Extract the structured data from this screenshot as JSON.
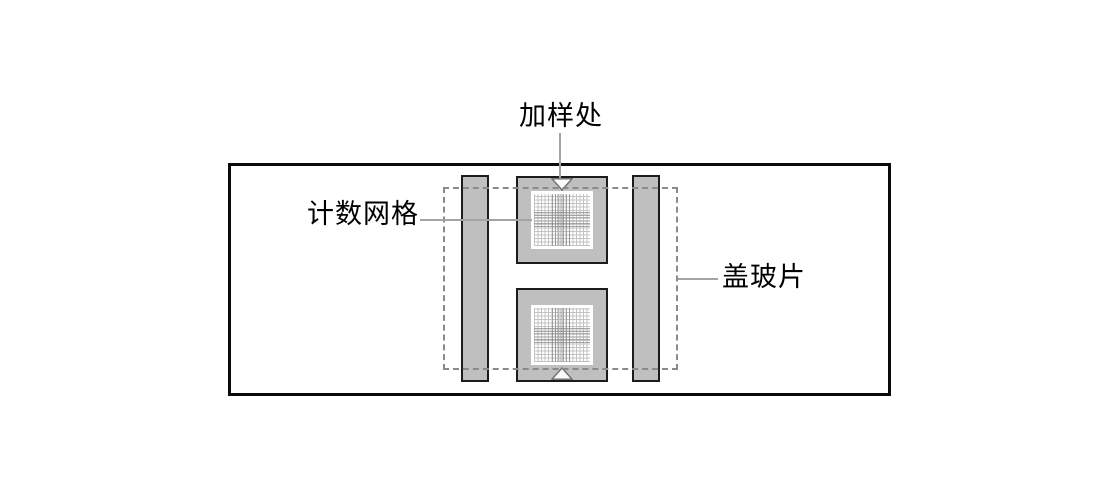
{
  "labels": {
    "sample_port": "加样处",
    "counting_grid": "计数网格",
    "cover_glass": "盖玻片"
  },
  "colors": {
    "background": "#ffffff",
    "slide_border": "#0a0a0a",
    "shape_fill": "#bfbfbf",
    "shape_border": "#1c1c1c",
    "dashed_outline": "#8a8a8a",
    "leader_line": "#a3a3a3",
    "grid_bg": "#ffffff",
    "grid_line_light": "#c3c3c3",
    "grid_line_dark": "#8a8a8a",
    "notch_fill": "#fafafa",
    "notch_border": "#6f6f6f",
    "text": "#000000"
  }
}
